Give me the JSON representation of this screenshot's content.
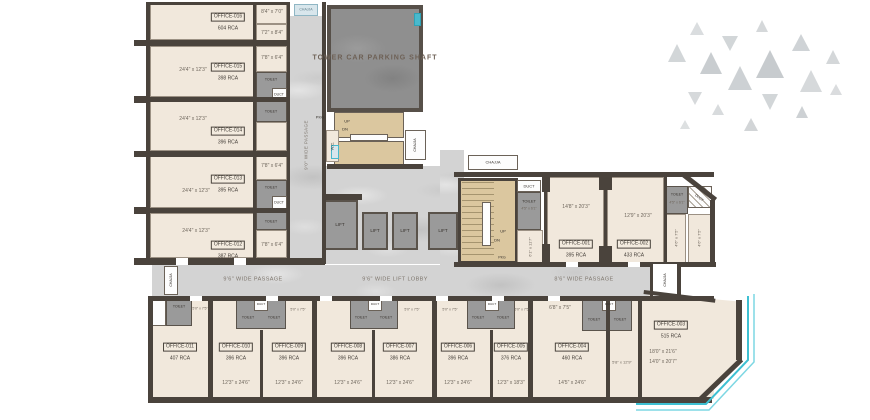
{
  "colors": {
    "wall": "#4a433c",
    "room_fill": "#f1e8dc",
    "service_gray": "#9a9a9a",
    "marble": "#d3d3d3",
    "stairs_tan": "#dbc79f",
    "accent_teal": "#3ec0d2",
    "chajja_blue": "#d8e6ec"
  },
  "labels": {
    "parking_shaft": "TOWER CAR PARKING SHAFT",
    "passage_vertical": "9'0\" WIDE PASSAGE",
    "passage_left": "9'6\" WIDE PASSAGE",
    "lift_lobby": "9'6\" WIDE LIFT LOBBY",
    "passage_right": "8'6\" WIDE PASSAGE",
    "chajja": "CHAJJA",
    "lift": "LIFT",
    "toilet": "TOILET",
    "duct": "DUCT",
    "up": "UP",
    "dn": "DN",
    "pkg": "PKG",
    "wc": "W.C."
  },
  "left_offices": [
    {
      "label": "OFFICE-016",
      "rca": "604 RCA",
      "dim": ""
    },
    {
      "label": "OFFICE-015",
      "rca": "398 RCA",
      "dim": "24'4\" x 12'3\""
    },
    {
      "label": "OFFICE-014",
      "rca": "396 RCA",
      "dim": "24'4\" x 12'3\""
    },
    {
      "label": "OFFICE-013",
      "rca": "395 RCA",
      "dim": "24'4\" x 12'3\""
    },
    {
      "label": "OFFICE-012",
      "rca": "387 RCA",
      "dim": "24'4\" x 12'3\""
    }
  ],
  "left_small_rooms": [
    "8'4\" x 7'0\"",
    "7'2\" x 8'4\"",
    "7'8\" x 6'4\"",
    "7'8\" x 6'4\"",
    "7'8\" x 6'4\""
  ],
  "right_offices": [
    {
      "label": "OFFICE-001",
      "rca": "395 RCA",
      "dim": "14'8\" x 20'3\""
    },
    {
      "label": "OFFICE-002",
      "rca": "433 RCA",
      "dim": "12'9\" x 20'3\""
    }
  ],
  "right_wing": {
    "toilet_dim": "4'5\" x 6'1\"",
    "room_dim_1": "4'6\" x 7'5\"",
    "room_dim_2": "4'6\" x 7'5\"",
    "stair_side_dim": "6'1\" x 11'7\""
  },
  "bottom_offices": [
    {
      "label": "OFFICE-011",
      "rca": "407 RCA",
      "dim": ""
    },
    {
      "label": "OFFICE-010",
      "rca": "396 RCA",
      "dim": "12'3\" x 24'6\""
    },
    {
      "label": "OFFICE-009",
      "rca": "396 RCA",
      "dim": "12'3\" x 24'6\""
    },
    {
      "label": "OFFICE-008",
      "rca": "396 RCA",
      "dim": "12'3\" x 24'6\""
    },
    {
      "label": "OFFICE-007",
      "rca": "386 RCA",
      "dim": "12'3\" x 24'6\""
    },
    {
      "label": "OFFICE-006",
      "rca": "396 RCA",
      "dim": "12'3\" x 24'6\""
    },
    {
      "label": "OFFICE-005",
      "rca": "376 RCA",
      "dim": "12'3\" x 18'3\""
    },
    {
      "label": "OFFICE-004",
      "rca": "460 RCA",
      "dim": "14'5\" x 24'6\""
    },
    {
      "label": "OFFICE-003",
      "rca": "515 RCA",
      "dim": "18'0\" x 21'6\"",
      "dim2": "14'0\" x 20'7\""
    }
  ],
  "bottom_dims": {
    "cluster_dim": "5'0\" x 7'5\"",
    "office_004_side": "6'8\" x 7'5\"",
    "between_004_003": "5'8\" x 12'9\""
  }
}
